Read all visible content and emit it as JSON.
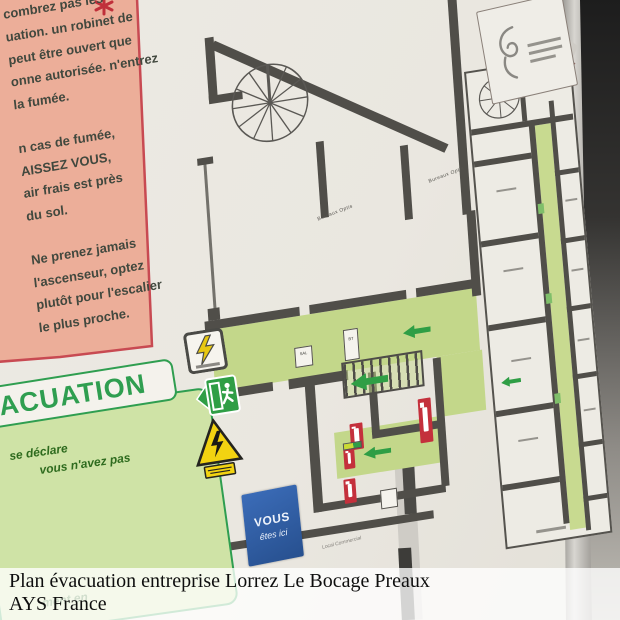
{
  "caption": {
    "title": "Plan évacuation entreprise Lorrez Le Bocage Preaux",
    "subtitle": "AYS France"
  },
  "instructions_panel": {
    "lines": [
      "combrez pas les",
      "uation.  un robinet de",
      "peut être ouvert que",
      "onne autorisée. n'entrez",
      "la fumée.",
      "n cas de fumée,",
      "AISSEZ VOUS,",
      "air frais est près",
      "du sol.",
      "Ne prenez jamais",
      "l'ascenseur, optez",
      "plutôt pour l'escalier",
      "le plus proche."
    ]
  },
  "evacuation_panel": {
    "header": "ACUATION",
    "body_lines": [
      "se déclare",
      "vous n'avez pas",
      "ment en"
    ]
  },
  "floor_plan": {
    "room_labels": [
      "Bureaux Optis",
      "Bureaux Optis"
    ],
    "local_label": "Local Commercial",
    "you_are_here": {
      "line1": "VOUS",
      "line2": "êtes ici"
    },
    "signs": {
      "sal": "SAL",
      "bt": "BT"
    }
  },
  "colors": {
    "accent_green": "#2f9e50",
    "corridor_green": "#c3d78a",
    "hazard_yellow": "#f2d311",
    "extinguisher_red": "#c4303c",
    "you_are_here_blue": "#2f5fae",
    "panel_pink": "#ecae99",
    "panel_pink_border": "#c84a52",
    "wall_gray": "#504e49"
  }
}
